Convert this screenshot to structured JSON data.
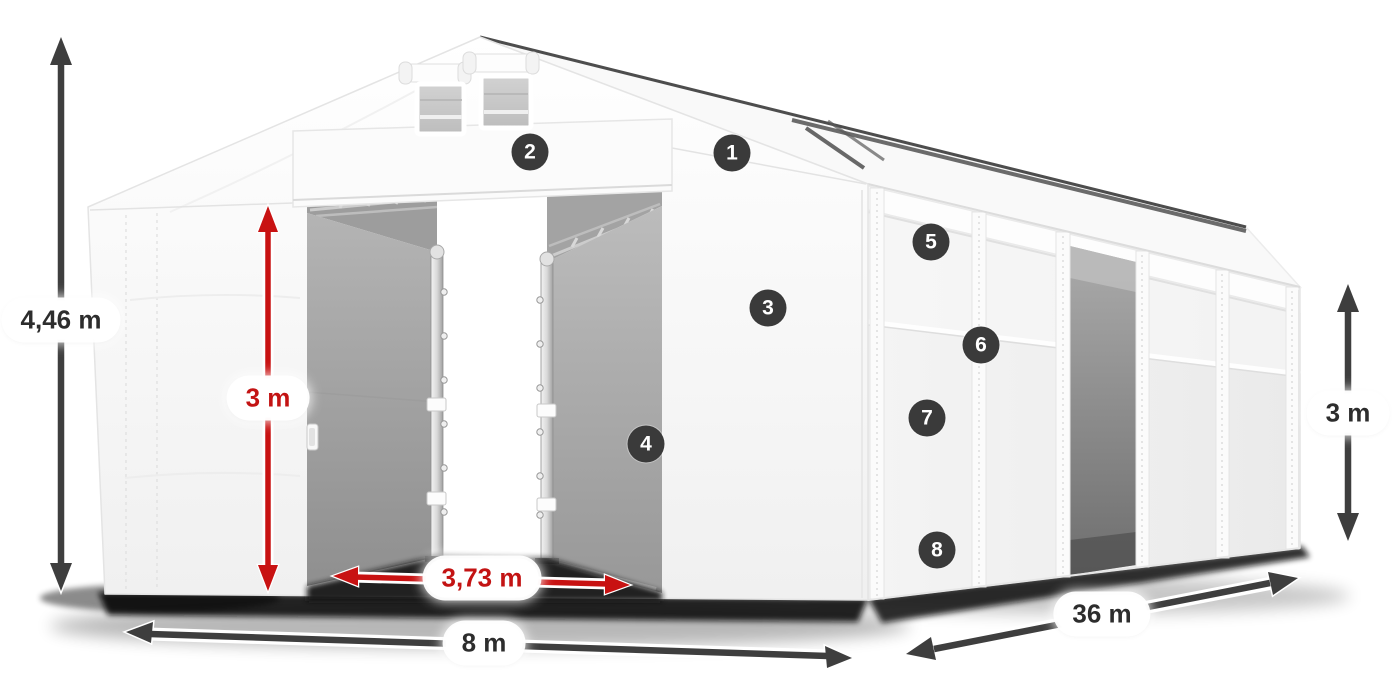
{
  "figure": {
    "type": "annotated-product-diagram",
    "subject": "white storage tent / marquee with open sliding doors, perspective view"
  },
  "colors": {
    "arrow_dark": "#3e3e3e",
    "arrow_red": "#c81212",
    "label_text_dark": "#2d2d2d",
    "label_text_red": "#c31313",
    "badge_bg": "#3a3a3a",
    "badge_text": "#ffffff",
    "tent_white": "#f7f7f7",
    "interior_gray": "#a5a5a5"
  },
  "dimension_labels": [
    {
      "id": "total-height",
      "text": "4,46 m",
      "color": "dark",
      "x": 61,
      "y": 320
    },
    {
      "id": "door-height",
      "text": "3 m",
      "color": "red",
      "x": 268,
      "y": 398
    },
    {
      "id": "door-width",
      "text": "3,73 m",
      "color": "red",
      "x": 482,
      "y": 578
    },
    {
      "id": "front-width",
      "text": "8 m",
      "color": "dark",
      "x": 484,
      "y": 643
    },
    {
      "id": "side-length",
      "text": "36 m",
      "color": "dark",
      "x": 1102,
      "y": 614
    },
    {
      "id": "side-height",
      "text": "3 m",
      "color": "dark",
      "x": 1348,
      "y": 413
    }
  ],
  "markers": [
    {
      "number": "1",
      "x": 732,
      "y": 153
    },
    {
      "number": "2",
      "x": 530,
      "y": 152
    },
    {
      "number": "3",
      "x": 768,
      "y": 308
    },
    {
      "number": "4",
      "x": 646,
      "y": 444
    },
    {
      "number": "5",
      "x": 931,
      "y": 242
    },
    {
      "number": "6",
      "x": 981,
      "y": 345
    },
    {
      "number": "7",
      "x": 927,
      "y": 418
    },
    {
      "number": "8",
      "x": 937,
      "y": 550
    }
  ]
}
